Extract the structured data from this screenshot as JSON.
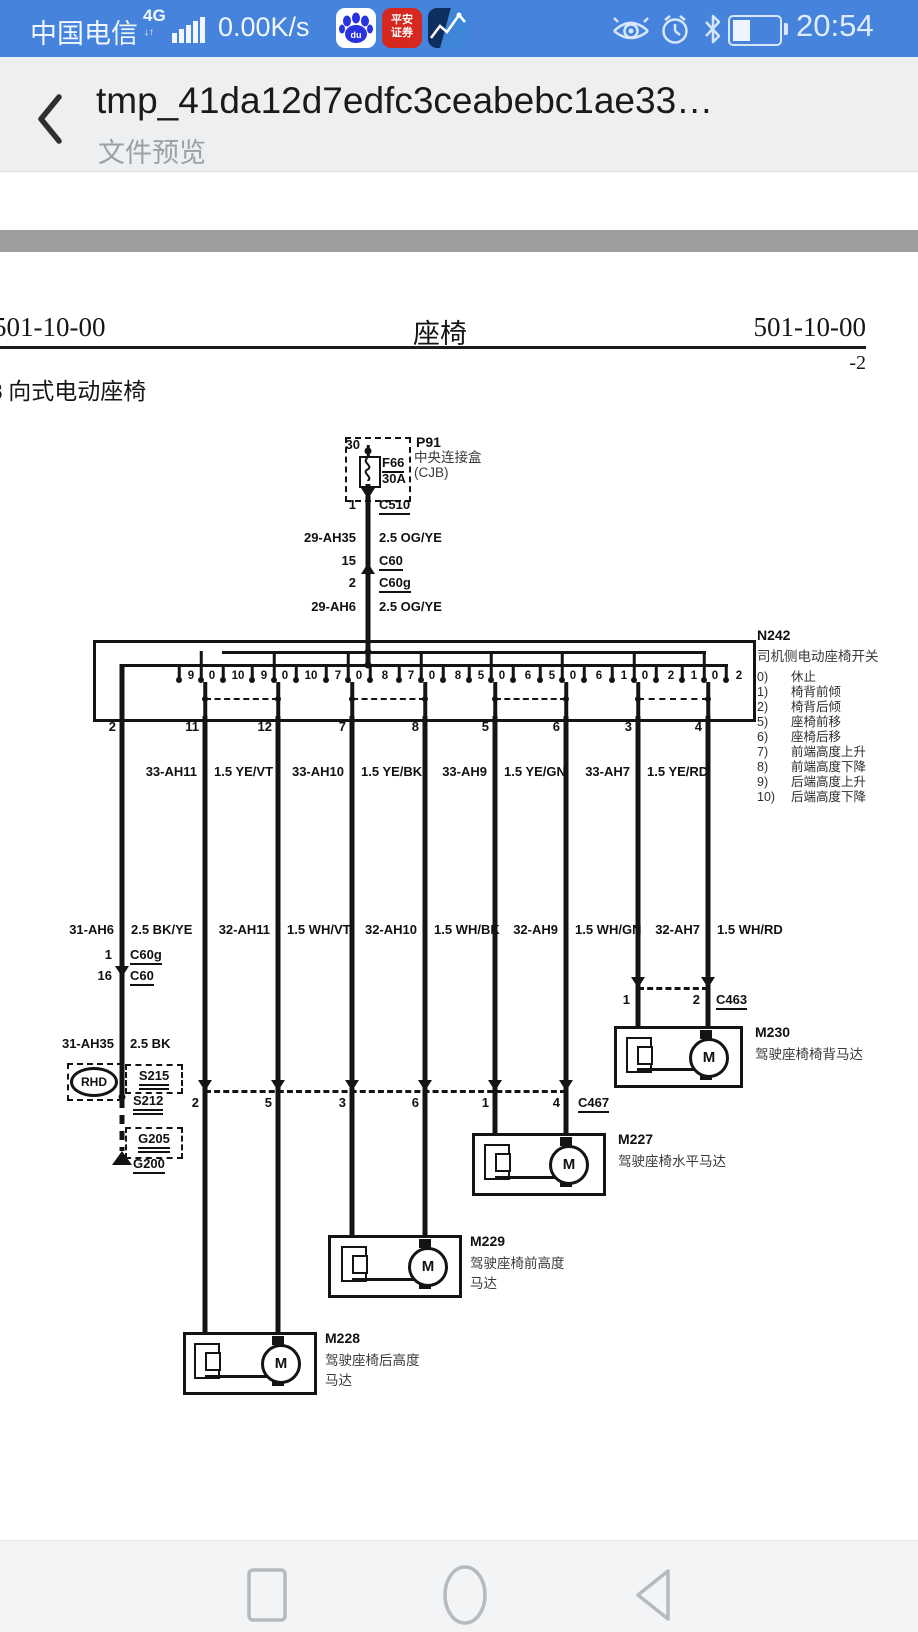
{
  "colors": {
    "status_bar_bg": "#4583dc",
    "header_bg": "#edeff1",
    "divider_gray": "#9c9ea0",
    "ink": "#141414",
    "nav_icon": "#b7babd",
    "pingan_red": "#d5281e",
    "baidu_blue": "#2932e1"
  },
  "status_bar": {
    "carrier": "中国电信",
    "network": "4G",
    "net_arrows": "↓↑",
    "speed": "0.00K/s",
    "time": "20:54",
    "baidu_label": "du",
    "pingan_line1": "平安",
    "pingan_line2": "证券"
  },
  "app_header": {
    "title": "tmp_41da12d7edfc3ceabebc1ae33…",
    "subtitle": "文件预览"
  },
  "doc": {
    "code_left": "501-10-00",
    "title_center": "座椅",
    "code_right": "501-10-00",
    "page_num": "-2",
    "section": "8 向式电动座椅",
    "p91": {
      "id": "P91",
      "terminal": "30",
      "fuse": "F66",
      "rating": "30A",
      "name1": "中央连接盒",
      "name2": "(CJB)"
    },
    "feed": {
      "pin_c510": "1",
      "c510": "C510",
      "circ1": "29-AH35",
      "wire1": "2.5 OG/YE",
      "pin_c60": "15",
      "c60": "C60",
      "pin_c60g": "2",
      "c60g": "C60g",
      "circ2": "29-AH6",
      "wire2": "2.5 OG/YE"
    },
    "n242": {
      "id": "N242",
      "name": "司机侧电动座椅开关",
      "positions": [
        {
          "n": "0)",
          "t": "休止"
        },
        {
          "n": "1)",
          "t": "椅背前倾"
        },
        {
          "n": "2)",
          "t": "椅背后倾"
        },
        {
          "n": "5)",
          "t": "座椅前移"
        },
        {
          "n": "6)",
          "t": "座椅后移"
        },
        {
          "n": "7)",
          "t": "前端高度上升"
        },
        {
          "n": "8)",
          "t": "前端高度下降"
        },
        {
          "n": "9)",
          "t": "后端高度上升"
        },
        {
          "n": "10)",
          "t": "后端高度下降"
        }
      ],
      "groups": [
        [
          "9",
          "0",
          "10"
        ],
        [
          "9",
          "0",
          "10"
        ],
        [
          "7",
          "0",
          "8"
        ],
        [
          "7",
          "0",
          "8"
        ],
        [
          "5",
          "0",
          "6"
        ],
        [
          "5",
          "0",
          "6"
        ],
        [
          "1",
          "0",
          "2"
        ],
        [
          "1",
          "0",
          "2"
        ]
      ],
      "pins": [
        "2",
        "11",
        "12",
        "7",
        "8",
        "5",
        "6",
        "3",
        "4"
      ]
    },
    "row1": [
      {
        "c": "33-AH11",
        "w": "1.5 YE/VT"
      },
      {
        "c": "33-AH10",
        "w": "1.5 YE/BK"
      },
      {
        "c": "33-AH9",
        "w": "1.5 YE/GN"
      },
      {
        "c": "33-AH7",
        "w": "1.5 YE/RD"
      }
    ],
    "row2": [
      {
        "c": "31-AH6",
        "w": "2.5 BK/YE"
      },
      {
        "c": "32-AH11",
        "w": "1.5 WH/VT"
      },
      {
        "c": "32-AH10",
        "w": "1.5 WH/BK"
      },
      {
        "c": "32-AH9",
        "w": "1.5 WH/GN"
      },
      {
        "c": "32-AH7",
        "w": "1.5 WH/RD"
      }
    ],
    "gnd": {
      "pin_c60g": "1",
      "c60g": "C60g",
      "pin_c60": "16",
      "c60": "C60",
      "circ": "31-AH35",
      "wire": "2.5 BK",
      "rhd": "RHD",
      "s215": "S215",
      "s212": "S212",
      "g205": "G205",
      "g200": "G200"
    },
    "c463": {
      "id": "C463",
      "p1": "1",
      "p2": "2"
    },
    "c467": {
      "id": "C467",
      "pins": [
        "2",
        "5",
        "3",
        "6",
        "1",
        "4"
      ]
    },
    "motors": {
      "m230": {
        "id": "M230",
        "l1": "驾驶座椅椅背马达"
      },
      "m227": {
        "id": "M227",
        "l1": "驾驶座椅水平马达"
      },
      "m229": {
        "id": "M229",
        "l1": "驾驶座椅前高度",
        "l2": "马达"
      },
      "m228": {
        "id": "M228",
        "l1": "驾驶座椅后高度",
        "l2": "马达"
      }
    },
    "motor_m": "M"
  }
}
